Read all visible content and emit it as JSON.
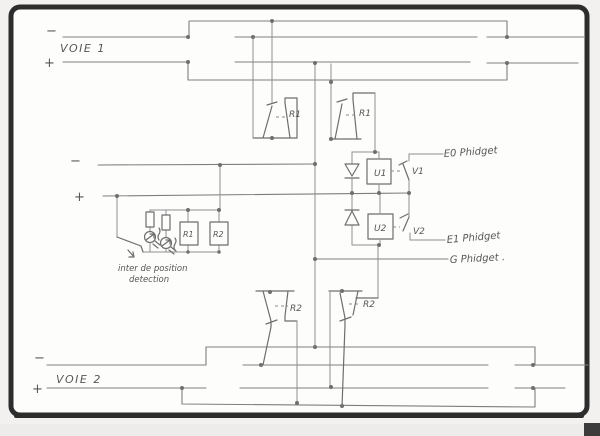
{
  "colors": {
    "paper": "#fdfdfc",
    "frame": "#2d2d2d",
    "pencil_wire": "#8f8f8f",
    "handwriting": "#565656"
  },
  "labels": {
    "voie1": "VOIE 1",
    "voie2": "VOIE 2",
    "minus": "−",
    "plus": "+",
    "relay_r1": "R1",
    "relay_r2": "R2",
    "coil_r1": "R1",
    "coil_r2": "R2",
    "opto_u1": "U1",
    "opto_u2": "U2",
    "contact_v1": "V1",
    "contact_v2": "V2",
    "phidget_e0": "E0 Phidget",
    "phidget_e1": "E1 Phidget",
    "phidget_g": "G Phidget .",
    "detector_line1": "inter de position",
    "detector_line2": "detection"
  }
}
